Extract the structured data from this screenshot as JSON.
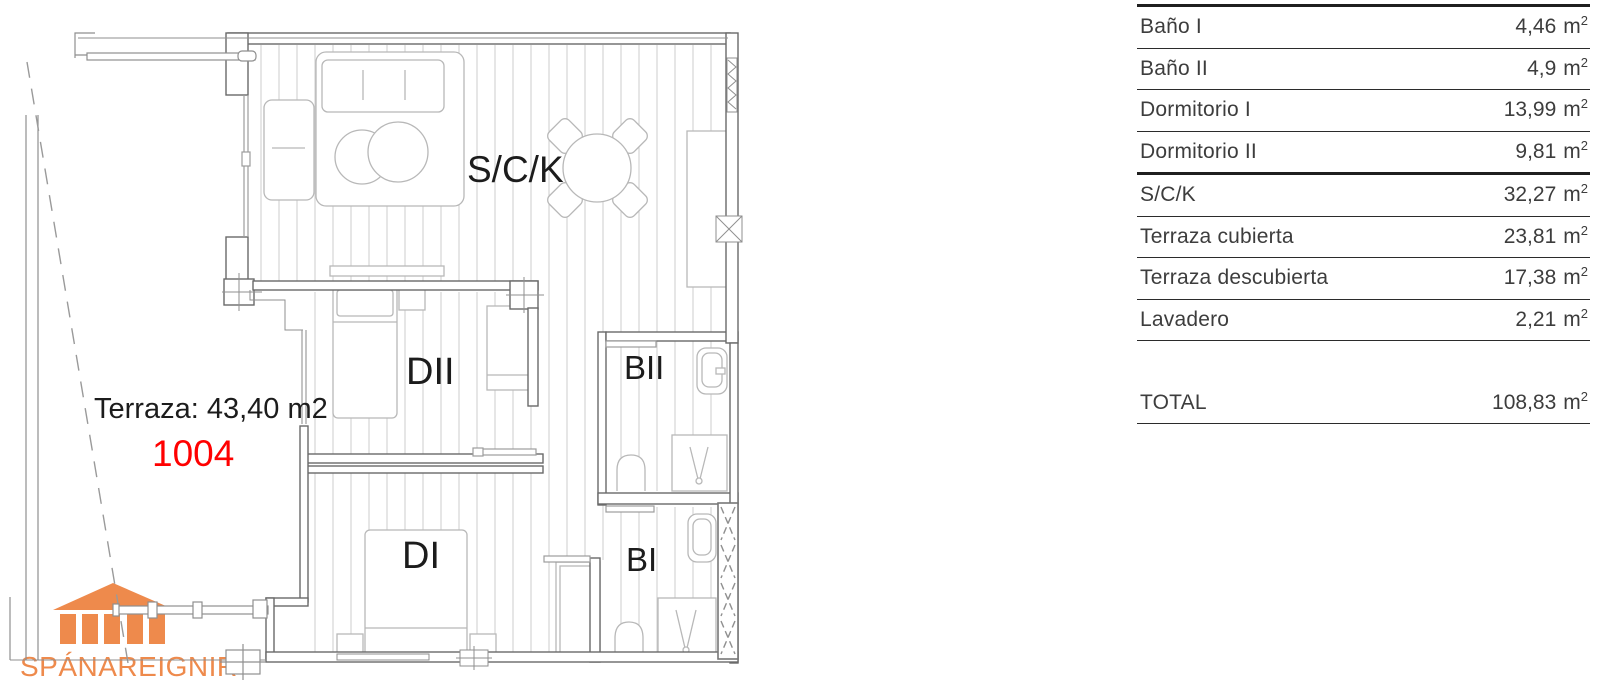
{
  "plan": {
    "terrace_label": "Terraza: 43,40 m2",
    "unit_number": "1004",
    "rooms": {
      "sck": "S/C/K",
      "dormitorio_2": "DII",
      "bano_2": "BII",
      "dormitorio_1": "DI",
      "bano_1": "BI"
    }
  },
  "logo": {
    "name": "SPÁNAREIGNIR",
    "icon": "temple-icon"
  },
  "area_table": {
    "unit_base": "m",
    "unit_sup": "2",
    "rows": [
      {
        "label": "Baño I",
        "value": "4,46"
      },
      {
        "label": "Baño II",
        "value": "4,9"
      },
      {
        "label": "Dormitorio I",
        "value": "13,99"
      },
      {
        "label": "Dormitorio II",
        "value": "9,81"
      },
      {
        "label": "S/C/K",
        "value": "32,27"
      },
      {
        "label": "Terraza cubierta",
        "value": "23,81"
      },
      {
        "label": "Terraza descubierta",
        "value": "17,38"
      },
      {
        "label": "Lavadero",
        "value": "2,21"
      }
    ],
    "total": {
      "label": "TOTAL",
      "value": "108,83"
    }
  },
  "colors": {
    "accent_orange": "#EE8A4C",
    "unit_number_red": "#FF0000"
  }
}
